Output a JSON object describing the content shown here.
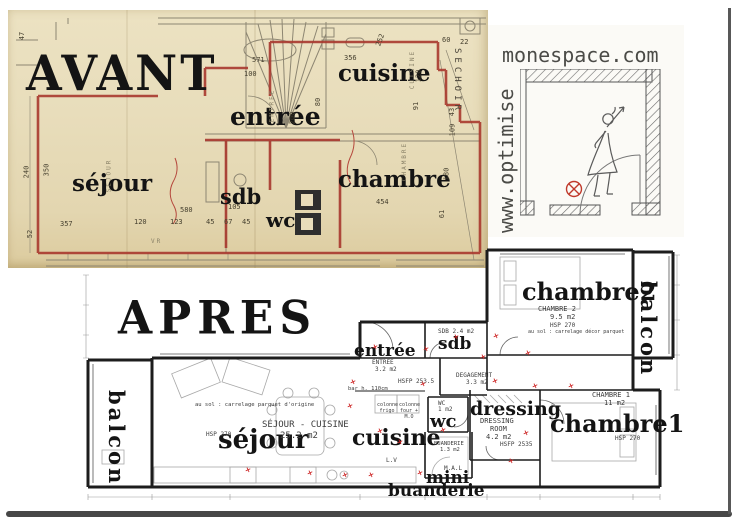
{
  "avant": {
    "title": "AVANT",
    "rooms": {
      "sejour": "séjour",
      "sdb": "sdb",
      "wc": "wc",
      "entree": "entrée",
      "cuisine": "cuisine",
      "chambre": "chambre",
      "sechoir": "SECHOIR"
    },
    "dimensions": [
      {
        "t": "580",
        "x": 172,
        "y": 196
      },
      {
        "t": "357",
        "x": 52,
        "y": 210
      },
      {
        "t": "120",
        "x": 126,
        "y": 208
      },
      {
        "t": "123",
        "x": 162,
        "y": 208
      },
      {
        "t": "45",
        "x": 198,
        "y": 208
      },
      {
        "t": "67",
        "x": 216,
        "y": 208
      },
      {
        "t": "45",
        "x": 234,
        "y": 208
      },
      {
        "t": "105",
        "x": 220,
        "y": 193
      },
      {
        "t": "454",
        "x": 368,
        "y": 188
      },
      {
        "t": "240",
        "x": 12,
        "y": 158,
        "r": -90
      },
      {
        "t": "350",
        "x": 32,
        "y": 156,
        "r": -90
      },
      {
        "t": "52",
        "x": 18,
        "y": 220,
        "r": -90
      },
      {
        "t": "571",
        "x": 244,
        "y": 46
      },
      {
        "t": "100",
        "x": 236,
        "y": 60
      },
      {
        "t": "356",
        "x": 336,
        "y": 44
      },
      {
        "t": "252",
        "x": 366,
        "y": 26,
        "r": -70
      },
      {
        "t": "60",
        "x": 434,
        "y": 26
      },
      {
        "t": "22",
        "x": 452,
        "y": 28
      },
      {
        "t": "43",
        "x": 440,
        "y": 98,
        "r": -90
      },
      {
        "t": "109",
        "x": 438,
        "y": 116,
        "r": -90
      },
      {
        "t": "180",
        "x": 432,
        "y": 160,
        "r": -90
      },
      {
        "t": "61",
        "x": 430,
        "y": 200,
        "r": -90
      },
      {
        "t": "200",
        "x": 278,
        "y": 104,
        "r": -90
      },
      {
        "t": "80",
        "x": 306,
        "y": 88,
        "r": -90
      },
      {
        "t": "120",
        "x": 404,
        "y": 62,
        "r": -90
      },
      {
        "t": "91",
        "x": 404,
        "y": 92,
        "r": -90
      },
      {
        "t": "47",
        "x": 10,
        "y": 22,
        "r": -90
      }
    ],
    "print_labels": [
      {
        "t": "CUISINE",
        "x": 385,
        "y": 56,
        "r": -90
      },
      {
        "t": "CHAMBRE",
        "x": 377,
        "y": 148,
        "r": -90
      },
      {
        "t": "SEJOUR",
        "x": 84,
        "y": 162,
        "r": -90
      },
      {
        "t": "ENTREE",
        "x": 247,
        "y": 92,
        "r": -90
      },
      {
        "t": "VR",
        "x": 143,
        "y": 228
      }
    ]
  },
  "logo": {
    "domain": "monespace.com",
    "vertical": "www.optimise"
  },
  "apres": {
    "title": "APRES",
    "rooms": {
      "balcon_left": "balcon",
      "sejour": "séjour",
      "cuisine": "cuisine",
      "entree": "entrée",
      "sdb": "sdb",
      "wc": "wc",
      "dressing": "dressing",
      "mini": "mini",
      "buanderie": "buanderie",
      "chambre1": "chambre1",
      "chambre2": "chambre2",
      "balcon_right": "balcon"
    },
    "labels": {
      "sejour_cuisine": "SÉJOUR - CUISINE",
      "sejour_area": "25.2 m2",
      "hsp_sejour": "HSP 270",
      "sol_sejour": "au sol : carrelage parquet d'origine",
      "entree_cap": "ENTREE",
      "entree_area": "3.2 m2",
      "sdb_cap": "SDB 2.4 m2",
      "degagement": "DEGAGEMENT",
      "degagement_area": "3.3 m2",
      "hsfp_1": "HSFP 253.5",
      "bar": "bar h. 110cm",
      "col_frigo": "colonne frigo",
      "col_four": "colonne four + M.O",
      "wc_cap": "WC",
      "wc_area": "1 m2",
      "dressing_cap": "DRESSING",
      "dressing_room": "ROOM",
      "dressing_area": "4.2 m2",
      "hsfp_2": "HSFP 2535",
      "lv": "L.V",
      "mal": "M.A.L",
      "buanderie_cap": "BUANDERIE",
      "buanderie_area": "1.3 m2",
      "chambre1_cap": "CHAMBRE 1",
      "chambre1_area": "11 m2",
      "hsp_chambre1": "HSP 270",
      "chambre2_cap": "CHAMBRE 2",
      "chambre2_area": "9.5 m2",
      "hsp_chambre2": "HSP 270",
      "sol_chambre2": "au sol : carrelage décor parquet"
    },
    "outlets": [
      {
        "x": 292,
        "y": 98
      },
      {
        "x": 343,
        "y": 100
      },
      {
        "x": 400,
        "y": 108
      },
      {
        "x": 445,
        "y": 104
      },
      {
        "x": 373,
        "y": 88
      },
      {
        "x": 413,
        "y": 87
      },
      {
        "x": 270,
        "y": 133
      },
      {
        "x": 340,
        "y": 135
      },
      {
        "x": 412,
        "y": 132
      },
      {
        "x": 452,
        "y": 137
      },
      {
        "x": 488,
        "y": 137
      },
      {
        "x": 267,
        "y": 157
      },
      {
        "x": 297,
        "y": 182
      },
      {
        "x": 360,
        "y": 181
      },
      {
        "x": 443,
        "y": 184
      },
      {
        "x": 317,
        "y": 193
      },
      {
        "x": 227,
        "y": 224
      },
      {
        "x": 262,
        "y": 226
      },
      {
        "x": 288,
        "y": 226
      },
      {
        "x": 337,
        "y": 224
      },
      {
        "x": 428,
        "y": 212
      },
      {
        "x": 165,
        "y": 221
      }
    ]
  },
  "colors": {
    "paper": "#e8ddbb",
    "wall_red": "#a8382e",
    "plan_ink": "#1d1d1d",
    "outlet_red": "#cc2020",
    "logo_gray": "#4b4b47"
  }
}
